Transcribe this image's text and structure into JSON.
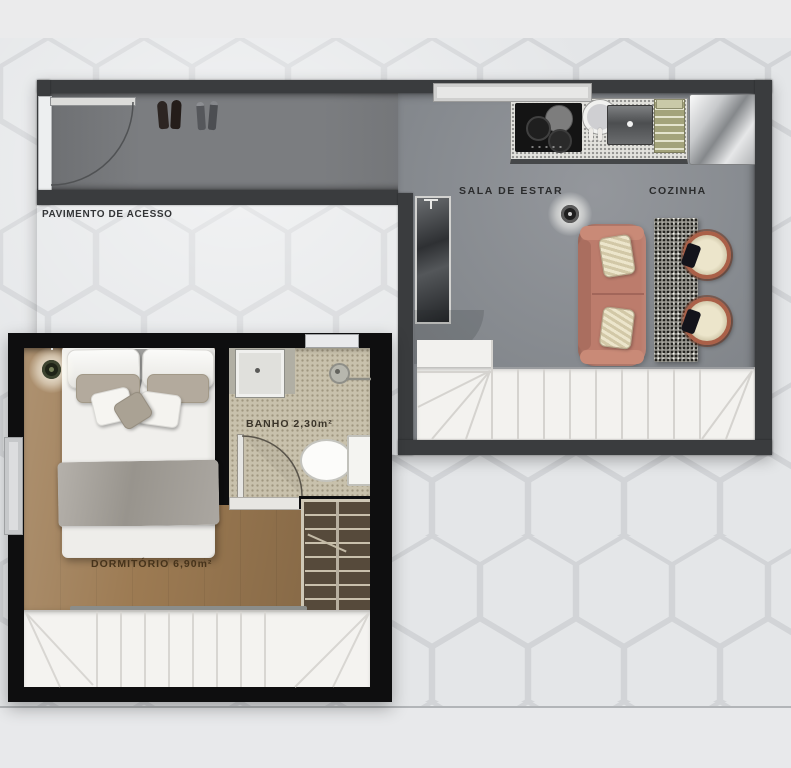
{
  "plan": {
    "type": "residential-floor-plan",
    "units": [
      "access-floor-with-living-kitchen",
      "bedroom-with-bathroom"
    ]
  },
  "rooms": {
    "corridor": {
      "label": "PAVIMENTO DE ACESSO"
    },
    "living": {
      "label": "SALA DE ESTAR"
    },
    "kitchen": {
      "label": "COZINHA"
    },
    "bathroom": {
      "label": "BANHO 2,30m²",
      "area_m2": "2,30"
    },
    "bedroom": {
      "label": "DORMITÓRIO 6,90m²",
      "area_m2": "6,90"
    }
  },
  "furniture_icons": [
    "entry-door",
    "shoes",
    "window",
    "kitchen-counter",
    "cooktop",
    "kitchen-sink",
    "oven",
    "dish-rack",
    "refrigerator",
    "ceiling-light",
    "mirror-door",
    "door-swing",
    "sofa",
    "sofa-cushion",
    "side-table",
    "dining-chair",
    "stairs-upper",
    "double-bed",
    "pillow",
    "blanket",
    "bedside-lamp",
    "window-bedroom",
    "shower-tray",
    "shower-head",
    "toilet",
    "bathroom-door",
    "wardrobe",
    "handrail",
    "stairs-lower"
  ],
  "colors": {
    "background": "#e4e6e8",
    "hex_pattern_line": "#c2c5c8",
    "upper_walls": "#3a3c3e",
    "lower_walls": "#0e0e0f",
    "living_floor": "#888b90",
    "corridor_floor": "#77797c",
    "wood_floor": "#9c7a52",
    "bathroom_floor": "#c8c1ac",
    "stairs": "#f3f2ef",
    "sofa": "#bc7c6c",
    "chair_rim": "#aa6048",
    "cushion": "#d9d0b2",
    "refrigerator": "#c7c9cb",
    "counter": "#e3e2dd",
    "label_text": "#2c2d2e"
  }
}
